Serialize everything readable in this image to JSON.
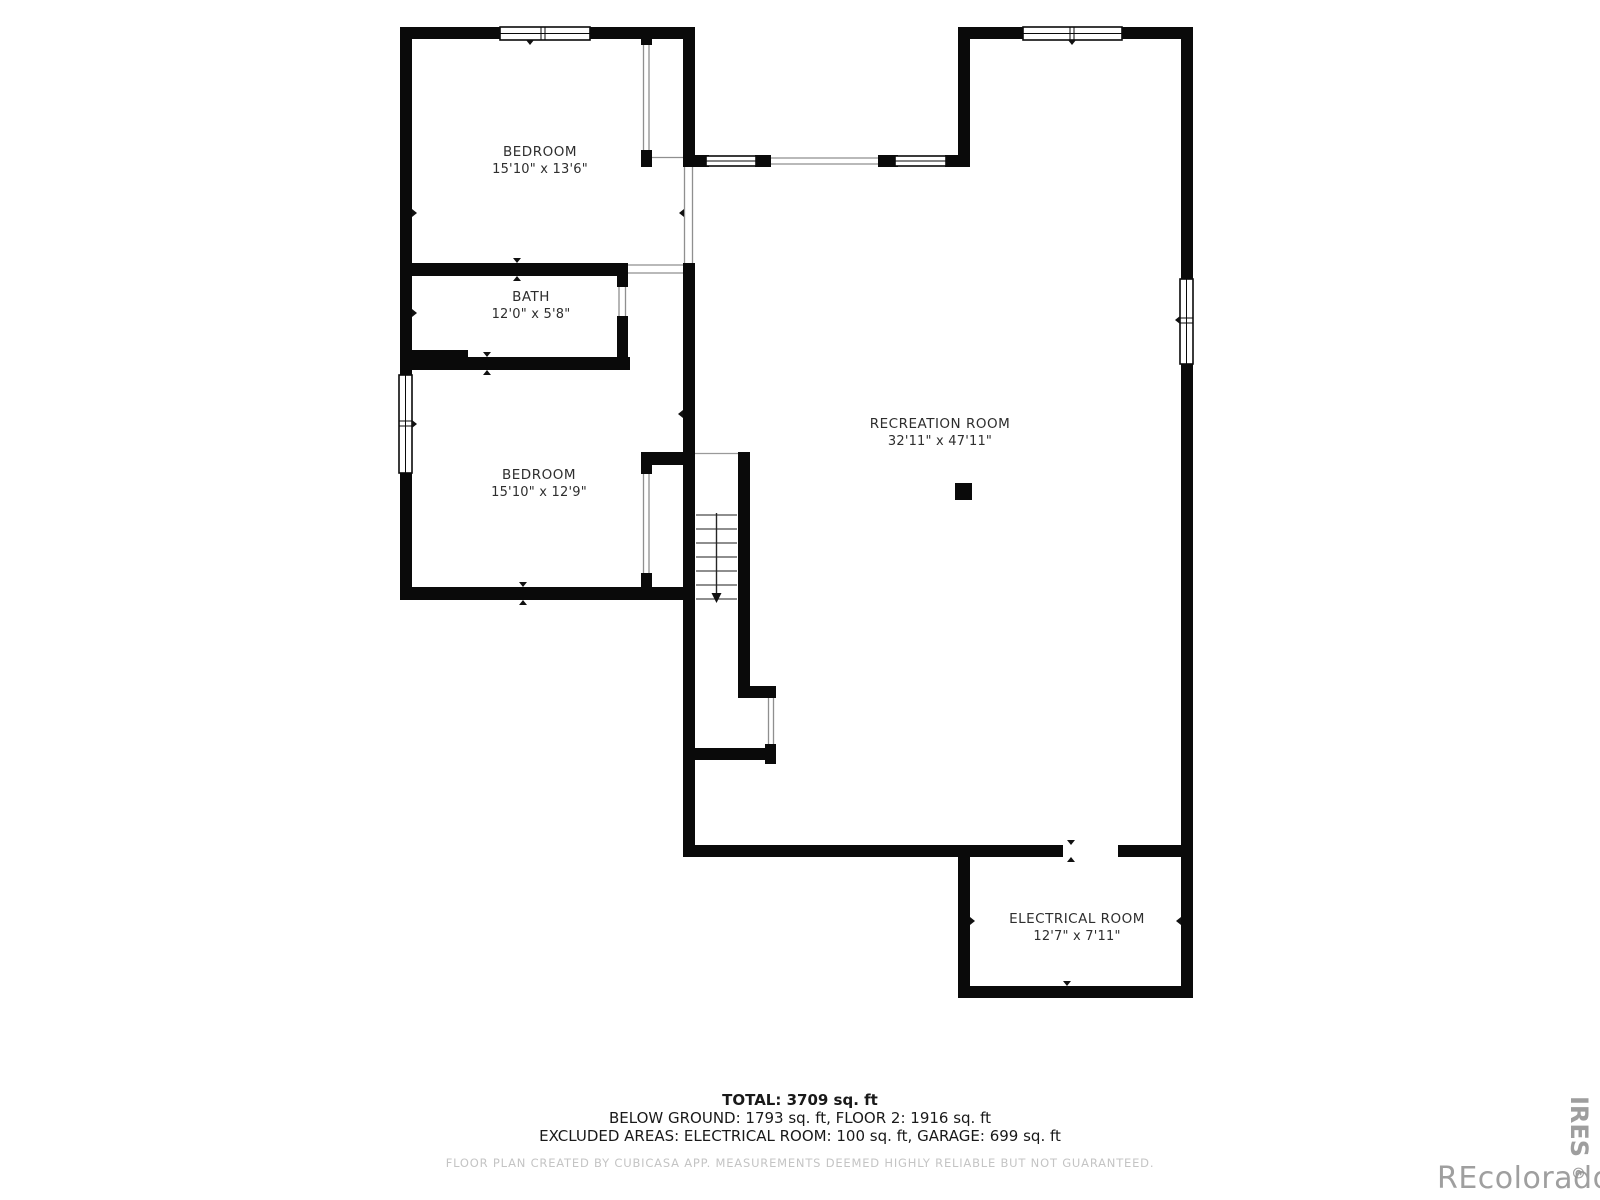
{
  "rooms": {
    "bedroom1": {
      "name": "BEDROOM",
      "dims": "15'10\" x 13'6\""
    },
    "bath": {
      "name": "BATH",
      "dims": "12'0\" x 5'8\""
    },
    "bedroom2": {
      "name": "BEDROOM",
      "dims": "15'10\" x 12'9\""
    },
    "recreation": {
      "name": "RECREATION ROOM",
      "dims": "32'11\" x 47'11\""
    },
    "electrical": {
      "name": "ELECTRICAL ROOM",
      "dims": "12'7\" x 7'11\""
    }
  },
  "footer": {
    "total": "TOTAL: 3709 sq. ft",
    "areas": "BELOW GROUND: 1793 sq. ft, FLOOR 2: 1916 sq. ft",
    "excluded": "EXCLUDED AREAS: ELECTRICAL ROOM: 100 sq. ft, GARAGE: 699 sq. ft",
    "disclaimer": "FLOOR PLAN CREATED BY CUBICASA APP. MEASUREMENTS DEEMED HIGHLY RELIABLE BUT NOT GUARANTEED."
  },
  "watermark": {
    "brand": "REcolorado",
    "side": "IRES",
    "copyright": "©"
  },
  "colors": {
    "wall": "#0a0a0a",
    "thin_line": "#8f8f8f",
    "room_label": "#2e2e2e",
    "disclaimer_text": "#c4c4c4",
    "watermark": "#8f8f8f",
    "background": "#ffffff"
  }
}
